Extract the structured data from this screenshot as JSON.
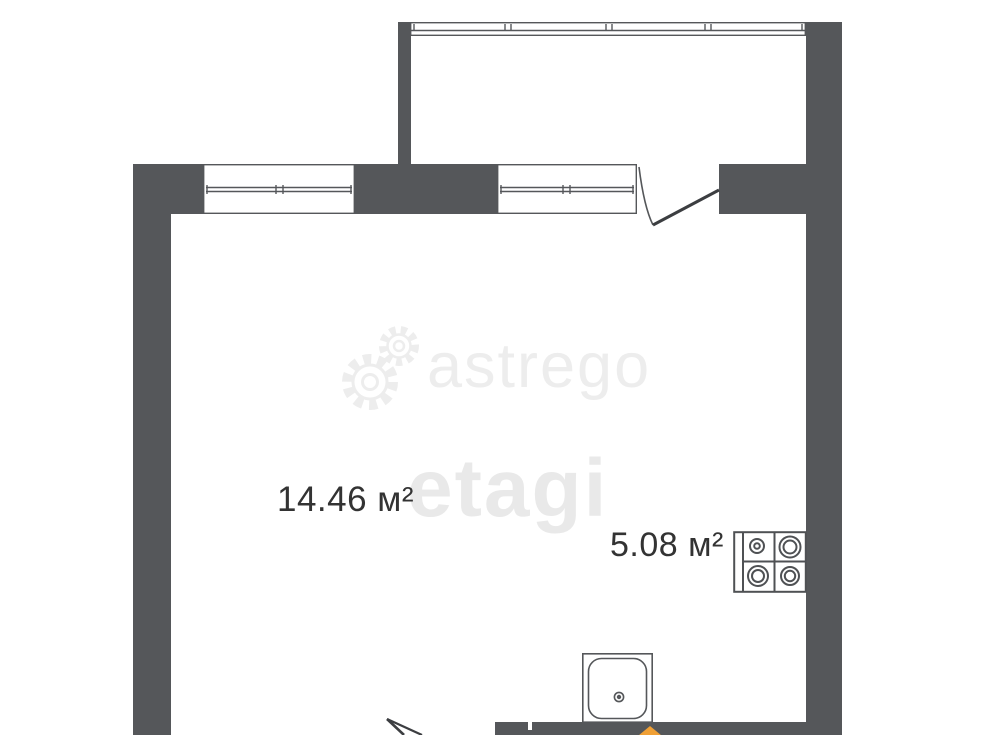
{
  "plan": {
    "type": "apartment-floor-plan",
    "rooms": [
      {
        "name": "room",
        "area_label": "14.46 м²"
      },
      {
        "name": "kitchen",
        "area_label": "5.08 м²"
      }
    ],
    "fixtures": [
      "stove-4-burner",
      "sink",
      "balcony-glazing",
      "window-left",
      "window-right",
      "balcony-door",
      "entrance-door"
    ]
  },
  "watermarks": {
    "astrego_text": "astrego",
    "etagi_text": "etagi"
  },
  "colors": {
    "wall": "#55575a",
    "line": "#4f5154",
    "label_text": "#333333",
    "watermark_gray": "#ededed",
    "accent_orange": "#f0a035",
    "background": "#ffffff"
  }
}
